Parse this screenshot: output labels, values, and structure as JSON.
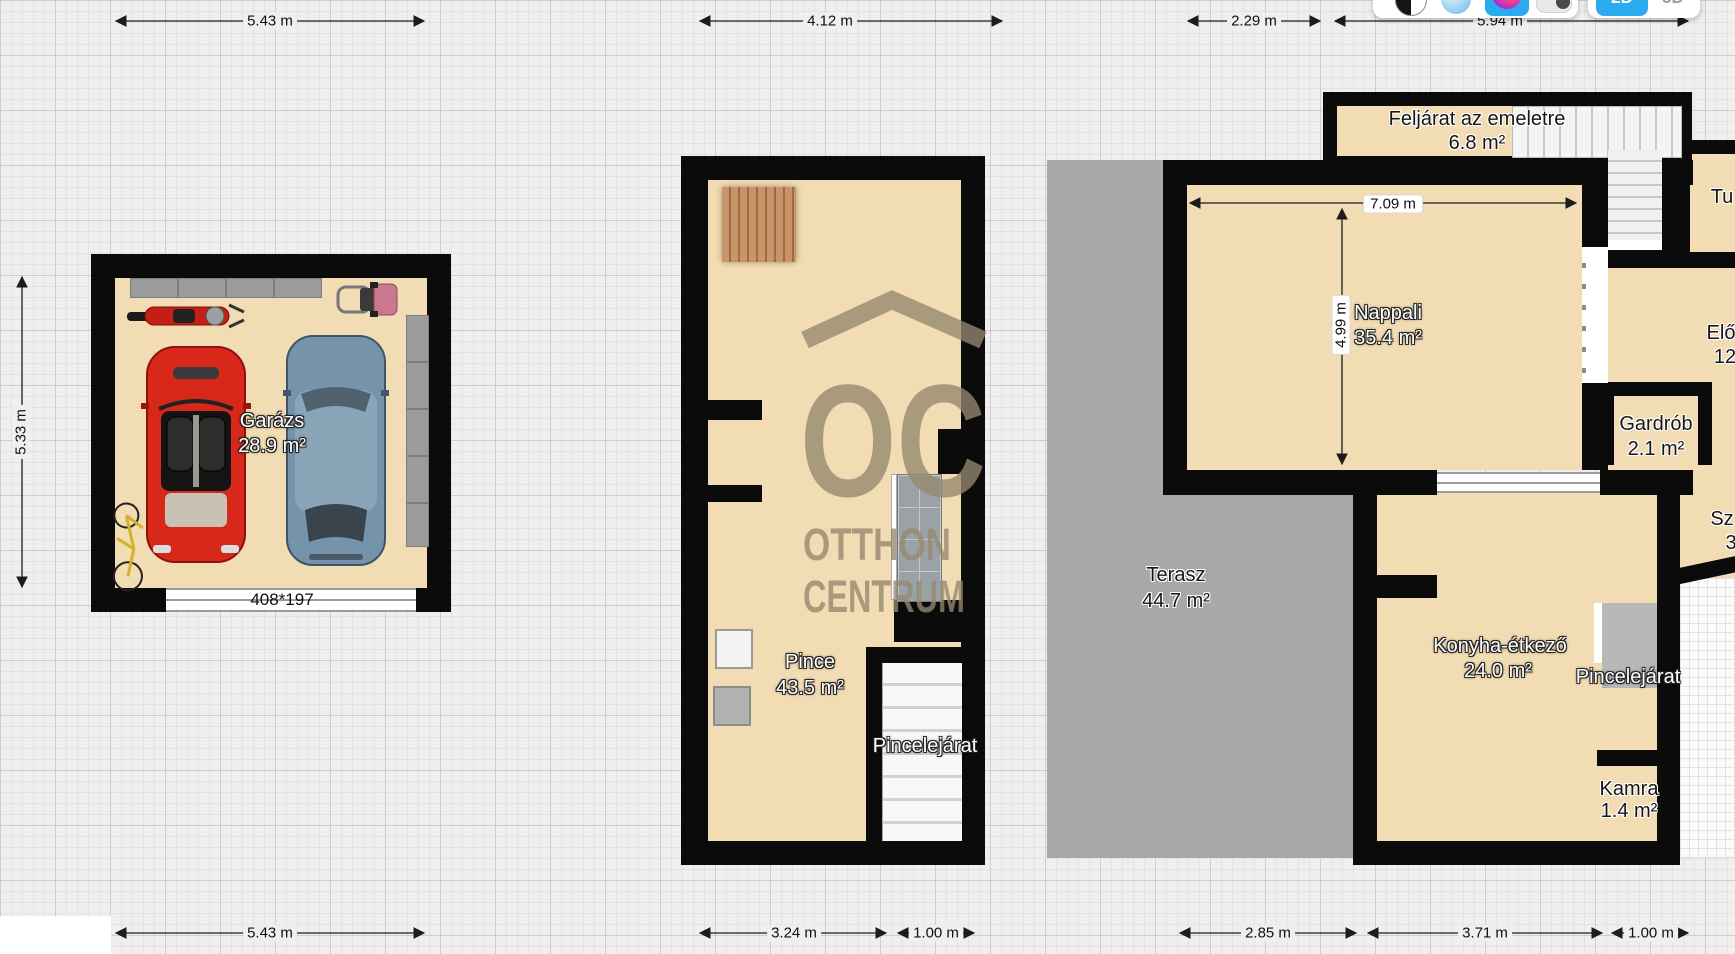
{
  "toolbar": {
    "icons": [
      "contrast-icon",
      "material-light-icon",
      "material-color-icon",
      "toggle-switch"
    ],
    "accent": "#2aabee",
    "view_2d_label": "2D",
    "view_3d_label": "3D"
  },
  "watermark": {
    "abbr": "OC",
    "line1": "OTTHON",
    "line2": "CENTRUM",
    "color": "#95886f"
  },
  "colors": {
    "wall": "#0b0b0b",
    "floor": "#f2dcb3",
    "terrace": "#a8a8a8",
    "grid_bg": "#f0efed"
  },
  "dims": {
    "top": [
      "5.43 m",
      "4.12 m",
      "2.29 m",
      "5.94 m"
    ],
    "bottom": [
      "5.43 m",
      "3.24 m",
      "1.00 m",
      "2.85 m",
      "3.71 m",
      "1.00 m"
    ],
    "left": "5.33 m",
    "inner_width": "7.09 m",
    "inner_height": "4.99 m",
    "garage_door": "408*197"
  },
  "rooms": {
    "garazs": {
      "name": "Garázs",
      "area": "28.9 m²"
    },
    "pince": {
      "name": "Pince",
      "area": "43.5 m²"
    },
    "pince_stairs_label": "Pincelejárat",
    "feljarat": {
      "name": "Feljárat az emeletre",
      "area": "6.8 m²"
    },
    "nappali": {
      "name": "Nappali",
      "area": "35.4 m²"
    },
    "terasz": {
      "name": "Terasz",
      "area": "44.7 m²"
    },
    "gardrob": {
      "name": "Gardrób",
      "area": "2.1 m²"
    },
    "konyha": {
      "name": "Konyha-étkező",
      "area": "24.0 m²"
    },
    "ground_stairs_label": "Pincelejárat",
    "kamra": {
      "name": "Kamra",
      "area": "1.4 m²"
    },
    "eloszoba": {
      "name": "Elő",
      "area": "12"
    },
    "tusolo": {
      "name": "Tu"
    },
    "szoba": {
      "name": "Sz",
      "area": "3"
    }
  }
}
